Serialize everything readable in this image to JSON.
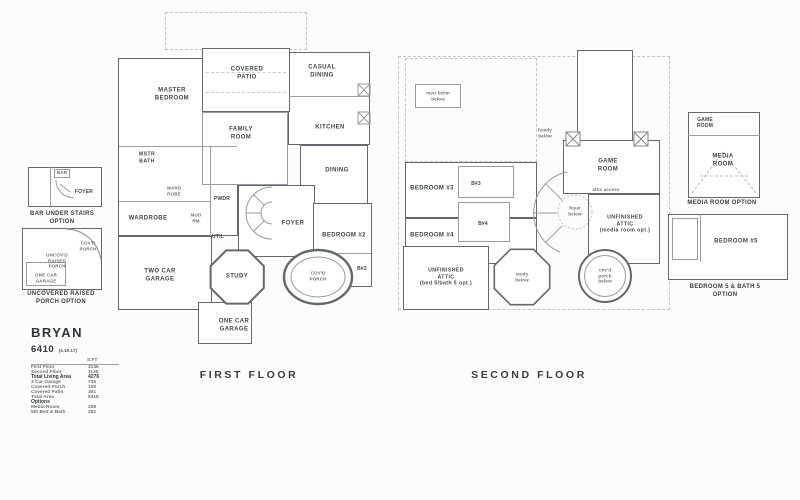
{
  "plan": {
    "name": "BRYAN",
    "number": "6410",
    "revision": "(4.19.17)"
  },
  "colors": {
    "background": "#fcfcfb",
    "wall": "#62686c",
    "thin_line": "#959ca1",
    "dashed_line": "#bfc5c9",
    "label_text": "#3f464c",
    "muted_text": "#6b7278"
  },
  "area_table": {
    "unit_header": "S.FT",
    "rows": [
      {
        "label": "First Floor",
        "value": "3146"
      },
      {
        "label": "Second Floor",
        "value": "1130"
      },
      {
        "label": "Total Living Area",
        "value": "4276"
      },
      {
        "label": "3 Car Garage",
        "value": "736"
      },
      {
        "label": "Covered Porch",
        "value": "105"
      },
      {
        "label": "Covered Patio",
        "value": "301"
      },
      {
        "label": "Total Area",
        "value": "5418"
      },
      {
        "label": "Options",
        "value": ""
      },
      {
        "label": "Media Room",
        "value": "258"
      },
      {
        "label": "5th Bed & Bath",
        "value": "282"
      }
    ]
  },
  "first_floor": {
    "title": "FIRST FLOOR",
    "rooms": {
      "master_bedroom": "MASTER\nBEDROOM",
      "covered_patio": "COVERED\nPATIO",
      "casual_dining": "CASUAL\nDINING",
      "family_room": "FAMILY\nROOM",
      "kitchen": "KITCHEN",
      "dining": "DINING",
      "mstr_bath": "MSTR\nBATH",
      "wardrobe": "WARDROBE",
      "ward_robe_closet": "WARD\nROBE",
      "mud_rm": "MUD\nRM",
      "pwdr": "PWDR",
      "util": "UTIL",
      "foyer": "FOYER",
      "bedroom_2": "BEDROOM #2",
      "bath_2": "B#2",
      "two_car_garage": "TWO CAR\nGARAGE",
      "study": "STUDY",
      "covd_porch": "COV'D\nPORCH",
      "one_car_garage": "ONE CAR\nGARAGE"
    }
  },
  "second_floor": {
    "title": "SECOND FLOOR",
    "rooms": {
      "bedroom_3": "BEDROOM #3",
      "bath_3": "B#3",
      "bedroom_4": "BEDROOM #4",
      "bath_4": "B#4",
      "game_room": "GAME\nROOM",
      "attic_access": "attic access",
      "foyer_below": "foyer\nbelow",
      "family_below": "family\nbelow",
      "mstr_bdrm_below": "mstr bdrm\nbelow",
      "unfinished_attic_media": "UNFINISHED\nATTIC\n(media room opt.)",
      "unfinished_attic_bed5": "UNFINISHED\nATTIC\n(bed 5/bath 5 opt.)",
      "study_below": "study\nbelow",
      "covd_porch_below": "cov'd\nporch\nbelow"
    }
  },
  "options": {
    "bar_under_stairs": {
      "caption": "BAR UNDER STAIRS\nOPTION",
      "bar_label": "BAR",
      "foyer_label": "FOYER"
    },
    "uncovered_raised_porch": {
      "caption": "UNCOVERED RAISED\nPORCH OPTION",
      "covd_porch_label": "COV'D\nPORCH",
      "uncovd_label": "UNCOV'D\nRAISED\nPORCH",
      "one_car_label": "ONE CAR\nGARAGE"
    },
    "media_room": {
      "caption": "MEDIA ROOM OPTION",
      "game_room_label": "GAME\nROOM",
      "media_room_label": "MEDIA\nROOM"
    },
    "bedroom_5": {
      "caption": "BEDROOM 5 & BATH 5\nOPTION",
      "bedroom_label": "BEDROOM #5"
    }
  }
}
